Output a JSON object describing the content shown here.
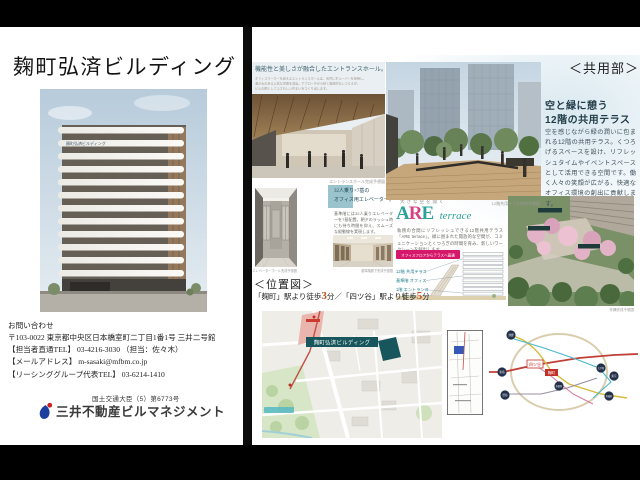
{
  "colors": {
    "accent_teal": "#2ba39b",
    "accent_magenta": "#d64583",
    "badge_pink": "#d6186b",
    "map_building_teal": "#17565c",
    "access_number_orange": "#c2511f",
    "route_highlight_red": "#c03028"
  },
  "left": {
    "title": "麹町弘済ビルディング",
    "building_sign": "麹町弘済ビルディング",
    "contact": {
      "heading": "お問い合わせ",
      "address": "〒103-0022 東京都中央区日本橋室町二丁目1番1号 三井二号館",
      "tel_direct": "【担当者直通TEL】 03-4216-3030 （担当：佐々木）",
      "email": "【メールアドレス】 m-sasaki@mfbm.co.jp",
      "tel_group": "【リーシンググループ代表TEL】 03-6214-1410"
    },
    "license": "国土交通大臣（5）第6773号",
    "company": "三井不動産ビルマネジメント"
  },
  "right": {
    "section_label": "＜共用部＞",
    "entrance": {
      "caption": "機能性と美しさが融合したエントランスホール。",
      "body_lines": [
        "オフィスワーカーを迎えるエントランスホールは、天井に木ルーバーを採用し、",
        "温かみのある上質な空間を演出。アプローチから続く開放的なしつらえが、",
        "ビルの顔としてふさわしい佇まいをつくり出します。"
      ],
      "credit": "エントランスホール完成予想図"
    },
    "terrace": {
      "heading1": "空と緑に憩う",
      "heading2": "12階の共用テラス",
      "body": "空を感じながら緑の潤いに包まれる12階の共用テラス。くつろげるスペースを設け、リフレッシュタイムやイベントスペースとして活用できる空間です。働く人々の笑顔が広がる、快適なオフィス環境の創出に貢献します。",
      "credit": "12階共用テラス完成予想図"
    },
    "elevator": {
      "heading1": "32人乗り×7基の",
      "heading2": "オフィス用エレベーター。",
      "body": "基準階には32人乗りエレベーターを7基配置。朝夕のラッシュ時にも待ち時間を抑え、スムーズな縦動線を実現します。",
      "credit": "エレベーターホール完成予想図",
      "corridor_credit": "基準階廊下完成予想図"
    },
    "are": {
      "tagline": "大きな空を開く",
      "logo_letters": [
        "A",
        "R",
        "E"
      ],
      "logo_script": "terrace",
      "body": "執務の合間にリフレッシュできる12階共用テラス「ARE terrace」。緑に囲まれた開放的な空間が、コミュニケーションとくつろぎの時間を育み、新しいワークシーンを創出します。",
      "badge": "オフィスフロアからテラスへ直通",
      "labels": [
        "12階 共用テラス",
        "基準階 オフィス",
        "1階 エントランス"
      ]
    },
    "aerial": {
      "credit": "外構完成予想図"
    },
    "location": {
      "label": "＜位置図＞",
      "access_pre": "「麹町」駅より徒歩",
      "min1": "3",
      "access_mid": "分／「四ツ谷」駅より徒歩",
      "min2": "5",
      "access_suf": "分",
      "map_building_label": "麹町弘済ビルディング"
    },
    "routemap": {
      "stations": [
        "池袋",
        "新宿",
        "渋谷",
        "永田町",
        "大手町",
        "東京",
        "有楽町"
      ],
      "highlight_station": "四ツ谷",
      "highlight_building": "麹町"
    }
  }
}
